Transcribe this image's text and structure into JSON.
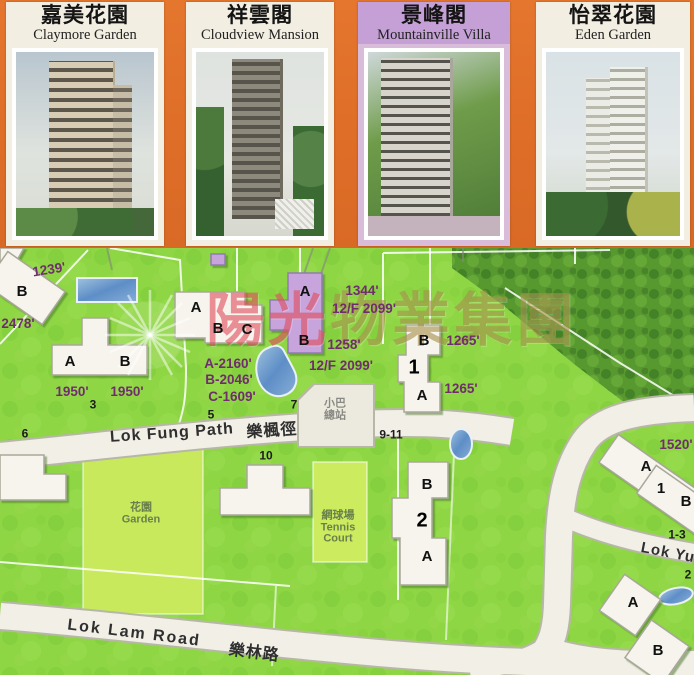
{
  "header": {
    "cards": [
      {
        "zh": "嘉美花園",
        "en": "Claymore Garden"
      },
      {
        "zh": "祥雲閣",
        "en": "Cloudview Mansion"
      },
      {
        "zh": "景峰閣",
        "en": "Mountainville Villa"
      },
      {
        "zh": "怡翠花園",
        "en": "Eden Garden"
      }
    ]
  },
  "map": {
    "watermark": {
      "part1": "陽光",
      "part2": "物業集團"
    },
    "roads": {
      "lok_fung_en": "Lok Fung Path",
      "lok_fung_zh": "樂楓徑",
      "lok_lam_en": "Lok Lam Road",
      "lok_lam_zh": "樂林路",
      "lok_yu_partial": "Lok Yu"
    },
    "areas": {
      "garden_zh": "花園",
      "garden_en": "Garden",
      "tennis_zh": "網球場",
      "tennis_en1": "Tennis",
      "tennis_en2": "Court",
      "minibus_line1": "小巴",
      "minibus_line2": "總站"
    },
    "measurements": {
      "ft_1239": "1239'",
      "ft_2478": "2478'",
      "ft_1950_a": "1950'",
      "ft_1950_b": "1950'",
      "ft_a2160": "A-2160'",
      "ft_b2046": "B-2046'",
      "ft_c1609": "C-1609'",
      "ft_1344": "1344'",
      "ft_2099_a": "12/F 2099'",
      "ft_1258": "1258'",
      "ft_2099_b": "12/F 2099'",
      "ft_1265_a": "1265'",
      "ft_1265_b": "1265'",
      "ft_1520": "1520'"
    },
    "lots": {
      "n3": "3",
      "n5": "5",
      "n6": "6",
      "n7": "7",
      "n10": "10",
      "n9_11": "9-11",
      "n1_3": "1-3",
      "n2": "2"
    },
    "blocks": {
      "topleft_b": "B",
      "claymore_a": "A",
      "claymore_b": "B",
      "cloudview_a": "A",
      "cloudview_b": "B",
      "cloudview_c": "C",
      "mountainville_a": "A",
      "mountainville_b": "B",
      "blk1_b": "B",
      "blk1_n": "1",
      "blk1_a": "A",
      "blk2_b": "B",
      "blk2_n": "2",
      "blk2_a": "A",
      "eden_a": "A",
      "eden_n": "1",
      "eden_b": "B",
      "se_a": "A",
      "se_b": "B"
    }
  },
  "colors": {
    "header_orange": "#df6f2a",
    "map_green": "#8cd341",
    "woods_green": "#57982f",
    "lawn_light": "#c8e95c",
    "road_fill": "#f1efe6",
    "building_purple": "#c8a4dd",
    "title_lavender": "#c5a0d6",
    "measurement_purple": "#702d6d",
    "watermark_red": "#df4f5e",
    "watermark_gold": "#a7914e",
    "pool_blue": "#6f9bcd"
  }
}
